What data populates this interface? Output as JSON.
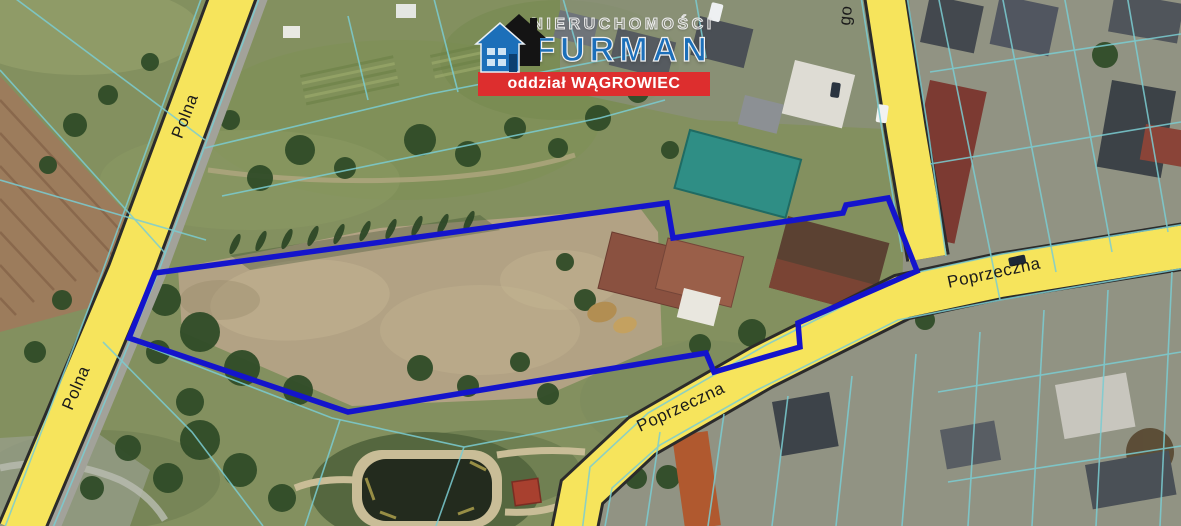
{
  "branding": {
    "name_top": "NIERUCHOMOŚCI",
    "name_main": "FURMAN",
    "branch": "oddział WĄGROWIEC",
    "banner_color": "#dd2e2e",
    "logo_blue": "#1c6fb9"
  },
  "streets": {
    "polna_upper": "Polna",
    "polna_lower": "Polna",
    "poprzeczna_right": "Poprzeczna",
    "poprzeczna_center": "Poprzeczna",
    "top_street_fragment": "go"
  },
  "map": {
    "imagery": "satellite",
    "parcel_outline_color": "#1414cc",
    "cadastral_color": "#7bcdd2",
    "road_fill": "#f6e45c"
  }
}
